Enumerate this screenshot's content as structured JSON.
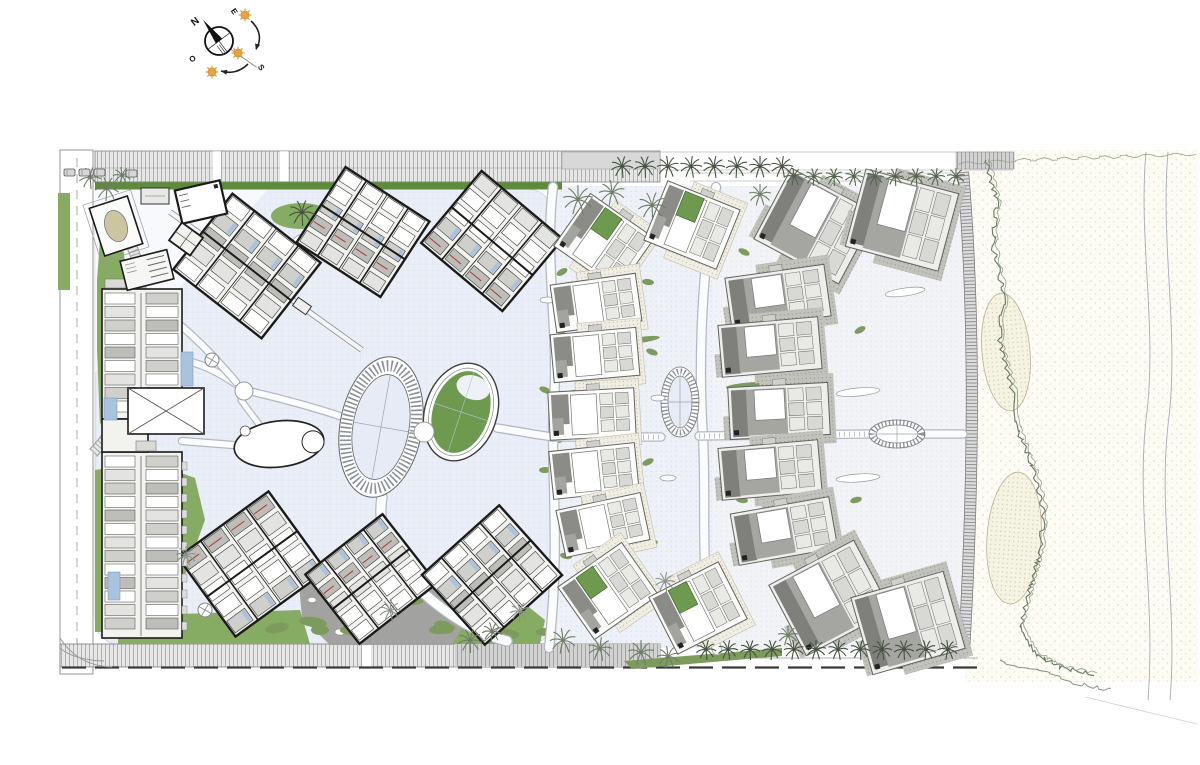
{
  "canvas": {
    "w": 1200,
    "h": 765,
    "bg": "#ffffff"
  },
  "palette": {
    "ink": "#1b1b1b",
    "paper": "#ffffff",
    "plaza": "#eaeef7",
    "plazaLine": "#dde3f0",
    "zone2": "#eef1f8",
    "zone3": "#f1f3f6",
    "dot": "#ccd4e6",
    "dot2": "#d6dae3",
    "sand": "#fcfbf4",
    "sandDot": "#cdc6af",
    "dune": "#f5f3e2",
    "duneDot": "#b9b194",
    "roadLight": "#e6e6e6",
    "roadMid": "#d2d2d2",
    "hatch": "#b0b0b0",
    "hatch2": "#a2a2a2",
    "roadEdge": "#7d7d7d",
    "hedge": "#5d8a3b",
    "lawn": "#86ab62",
    "olive": "#7d9b5d",
    "hedgeDark": "#3f6b2e",
    "palmDark": "#44523f",
    "palmMid": "#56644e",
    "palmSoft": "#6e7d66",
    "palmGray": "#8a958a",
    "blockFill": "#f2f2ef",
    "roomA": "#e3e3e1",
    "roomB": "#cfcfcc",
    "roomC": "#bdbdba",
    "roofD": "#7f7f7c",
    "roofM": "#a5a5a2",
    "roofS": "#8b8b88",
    "villaLine": "#62625f",
    "green2": "#6d9a4e",
    "blue": "#a9c3de",
    "red": "#b23a2c",
    "sun": "#e8a33d",
    "sunRay": "#d1912e",
    "pathCase": "#b3b8c2",
    "pathFill": "#fbfcfe",
    "corridorCase": "#8a8a8a",
    "grayShape": "#a2a2a0",
    "stipBg": "#f0eee3",
    "stipDot": "#a9a48c",
    "stipDBg": "#c2c2bc",
    "stipDDot": "#86867e",
    "shore": "#a8adb5",
    "veg": "#6a7862",
    "vegSoft": "#93a089",
    "boardTick": "#8f8f8f",
    "water": "#e6ebf5"
  },
  "compass": {
    "cx": 219,
    "cy": 41,
    "r": 14,
    "needle_deg": -127,
    "axis_deg": 53,
    "sunline_deg": 35,
    "letters": [
      {
        "t": "N",
        "x": 197,
        "y": 24,
        "rot": -38,
        "size": 10
      },
      {
        "t": "E",
        "x": 232,
        "y": 13,
        "rot": 55,
        "size": 8
      },
      {
        "t": "S",
        "x": 259,
        "y": 69,
        "rot": 55,
        "size": 8
      },
      {
        "t": "O",
        "x": 194,
        "y": 61,
        "rot": -35,
        "size": 8
      }
    ],
    "suns": [
      {
        "x": 245,
        "y": 15,
        "r": 4
      },
      {
        "x": 238,
        "y": 53,
        "r": 4
      },
      {
        "x": 212,
        "y": 72,
        "r": 4
      }
    ],
    "arrows": [
      {
        "d": "M251,21 C260,29 262,40 256,49",
        "tip": [
          256,
          50
        ],
        "ang": 105
      },
      {
        "d": "M248,64 C240,72 230,74 221,71",
        "tip": [
          221,
          71
        ],
        "ang": 192
      }
    ]
  },
  "roads": {
    "top": {
      "x": 95,
      "y": 151,
      "w": 565,
      "h": 31,
      "gaps": [
        213,
        280
      ],
      "hedge": [
        95,
        181.5,
        467,
        8
      ]
    },
    "promenade": [
      562,
      152,
      98,
      17
    ],
    "beach_link": [
      956,
      152,
      58,
      17
    ],
    "top_lines": [
      [
        60,
        151,
        660,
        151
      ],
      [
        60,
        182,
        660,
        182
      ],
      [
        660,
        152,
        1013,
        152
      ],
      [
        660,
        170,
        1013,
        170
      ],
      [
        690,
        173,
        958,
        173
      ],
      [
        690,
        181,
        958,
        181
      ]
    ],
    "left": {
      "x": 60,
      "y": 150,
      "w": 33,
      "h": 524,
      "dash_x": 77
    },
    "bottom": {
      "x": 60,
      "y": 644,
      "w": 600,
      "h": 23,
      "gap": 362,
      "dark_from": 455
    },
    "bottom_dash": [
      62,
      667.5,
      978,
      667.5
    ],
    "bottom_thin": [
      660,
      658,
      978,
      658
    ],
    "corner_curves": [
      "M60,638 Q78,666 112,667",
      "M60,648 Q74,660 104,661"
    ]
  },
  "zones": {
    "plaza": [
      95,
      189,
      458,
      456
    ],
    "entrance_blob": "M95,189 L268,189 C236,226 206,254 176,292 C150,325 122,356 95,372 Z",
    "zone2": [
      553,
      186,
      160,
      462
    ],
    "zone3": [
      713,
      186,
      252,
      464
    ]
  },
  "paths": {
    "walks": [
      {
        "d": "M553,187 C544,262 559,330 554,400 C550,470 561,540 549,648",
        "w": 8
      },
      {
        "d": "M716,187 C702,268 698,360 703,437 C707,515 698,585 717,650",
        "w": 8
      },
      {
        "d": "M497,428 C523,432 537,435 553,437 L661,437",
        "w": 7
      },
      {
        "d": "M699,436 L869,434",
        "w": 7
      },
      {
        "d": "M925,434 L963,434",
        "w": 7
      },
      {
        "d": "M253,392 C292,401 322,410 346,418",
        "w": 6
      },
      {
        "d": "M236,384 C214,369 196,362 179,359",
        "w": 6
      },
      {
        "d": "M241,400 C251,414 259,424 265,432",
        "w": 5
      },
      {
        "d": "M382,497 C375,541 401,580 450,614 C472,629 491,637 507,641",
        "w": 9
      },
      {
        "d": "M182,441 C206,443 221,444 233,445",
        "w": 6
      },
      {
        "d": "M150,302 C192,331 216,359 236,382",
        "w": 6
      }
    ],
    "corridors": [
      {
        "d": "M170,212 L362,350",
        "w": 6
      }
    ],
    "drive": "M93,213 C132,226 143,262 141,306 C139,352 132,396 112,429 C105,440 98,448 93,453",
    "axis_ticks": [
      "M553,437 L661,437",
      "M699,436 L869,434"
    ]
  },
  "lagoon": {
    "pond": {
      "cx": 279,
      "cy": 444,
      "rx": 45,
      "ry": 23,
      "rot": -7,
      "inner": {
        "dx": 34,
        "dy": 2,
        "r": 11
      },
      "nub": {
        "dx": -32,
        "dy": -17,
        "r": 5
      }
    },
    "ring": {
      "cx": 381,
      "cy": 427,
      "rot": 10,
      "rxO": 41,
      "ryO": 71,
      "rxI": 28,
      "ryI": 53
    },
    "green_oval": {
      "cx": 461,
      "cy": 412,
      "rot": 18,
      "rxO": 36,
      "ryO": 50,
      "rxR": 31,
      "ryR": 45,
      "rxI": 28,
      "ryI": 42,
      "crescent": {
        "dx": 4,
        "dy": -27,
        "rx": 17,
        "ry": 12
      }
    },
    "node": {
      "cx": 244,
      "cy": 391,
      "r": 9
    },
    "blob": {
      "cx": 424,
      "cy": 432,
      "r": 10
    },
    "oval_node_v": {
      "cx": 680,
      "cy": 402,
      "rxO": 19,
      "ryO": 35,
      "rxI": 12,
      "ryI": 26
    },
    "oval_node_h": {
      "cx": 897,
      "cy": 434,
      "rxO": 28,
      "ryO": 14,
      "rxI": 21,
      "ryI": 9
    }
  },
  "buildings": {
    "hotel_blocks": [
      [
        247,
        266,
        112,
        96,
        38
      ],
      [
        363,
        232,
        100,
        90,
        33
      ],
      [
        492,
        241,
        106,
        94,
        40
      ],
      [
        252,
        564,
        112,
        98,
        -36
      ],
      [
        371,
        579,
        98,
        88,
        -38
      ],
      [
        492,
        575,
        104,
        94,
        -42
      ]
    ],
    "left_wing": {
      "base1": [
        102,
        289,
        80,
        130
      ],
      "base2": [
        102,
        452,
        80,
        186
      ],
      "mid": [
        102,
        419,
        46,
        33
      ],
      "xhall": [
        128,
        388,
        76,
        46
      ],
      "pools": [
        [
          181,
          352,
          12,
          34
        ],
        [
          104,
          398,
          13,
          22
        ],
        [
          108,
          572,
          12,
          28
        ]
      ],
      "canopies": [
        [
          105,
          279,
          30,
          9
        ],
        [
          136,
          441,
          20,
          10
        ]
      ]
    },
    "entrance": [
      {
        "type": "white_rect",
        "cx": 201,
        "cy": 202,
        "w": 46,
        "h": 34,
        "rot": -13
      },
      {
        "type": "oval_pavilion",
        "cx": 116,
        "cy": 226,
        "w": 40,
        "h": 50,
        "rot": -18,
        "oval": {
          "rx": 11,
          "ry": 16,
          "fill": "#cbc5a2"
        }
      },
      {
        "type": "striped",
        "cx": 147,
        "cy": 270,
        "w": 48,
        "h": 30,
        "rot": -14
      },
      {
        "type": "dark_square",
        "cx": 186,
        "cy": 239,
        "w": 26,
        "h": 22,
        "rot": 36
      },
      {
        "type": "svc",
        "cx": 155,
        "cy": 196,
        "w": 28,
        "h": 16,
        "rot": 0
      }
    ],
    "stair_rect": [
      302,
      306,
      16,
      10,
      35
    ]
  },
  "villas": {
    "small": {
      "w": 86,
      "h": 48,
      "aw": 78,
      "ah": 64,
      "list": [
        [
          604,
          242,
          35,
          "a"
        ],
        [
          692,
          225,
          22,
          "a"
        ],
        [
          596,
          303,
          -8,
          "c"
        ],
        [
          595,
          355,
          -5,
          "c"
        ],
        [
          592,
          414,
          -3,
          "c"
        ],
        [
          594,
          471,
          -6,
          "c"
        ],
        [
          603,
          525,
          -12,
          "c"
        ],
        [
          608,
          591,
          -35,
          "a"
        ],
        [
          698,
          608,
          -27,
          "a"
        ]
      ]
    },
    "large": {
      "w": 100,
      "h": 52,
      "aw": 96,
      "ah": 80,
      "list": [
        [
          815,
          226,
          28,
          "a"
        ],
        [
          902,
          220,
          15,
          "a"
        ],
        [
          778,
          297,
          -8,
          "c"
        ],
        [
          770,
          347,
          -5,
          "c"
        ],
        [
          779,
          411,
          -3,
          "c"
        ],
        [
          770,
          470,
          -5,
          "c"
        ],
        [
          784,
          531,
          -10,
          "c"
        ],
        [
          830,
          598,
          -28,
          "a"
        ],
        [
          908,
          623,
          -16,
          "a"
        ]
      ]
    }
  },
  "greens": {
    "lawns": [
      "95,470 150,462 195,478 205,520 185,575 150,612 112,632 95,632",
      "118,616 300,610 310,644 118,644",
      "428,598 470,588 520,600 545,620 540,644 452,644 430,622",
      "58,193 70,193 70,290 58,290",
      "100,240 124,252 128,300 124,355 112,400 100,425 97,350 97,280"
    ],
    "gray_blob": "298,572 352,556 408,570 452,590 468,618 452,645 330,645 302,618",
    "blob_trees": [
      [
        330,
        588,
        14,
        8,
        -20
      ],
      [
        368,
        614,
        16,
        9,
        12
      ],
      [
        414,
        598,
        12,
        7,
        -5
      ],
      [
        444,
        627,
        10,
        6,
        20
      ],
      [
        320,
        630,
        9,
        5,
        0
      ]
    ],
    "pebbles": [
      [
        312,
        600,
        4,
        2.5
      ],
      [
        340,
        632,
        5,
        3
      ]
    ],
    "hedge_small": [
      107,
      552,
      26,
      12,
      -5
    ],
    "palm_oval": [
      301,
      216,
      30,
      13
    ],
    "olive_row": [
      [
        277,
        628,
        12,
        5,
        -10
      ],
      [
        313,
        622,
        14,
        5,
        8
      ],
      [
        352,
        630,
        12,
        5,
        0
      ],
      [
        442,
        629,
        13,
        5,
        -6
      ],
      [
        507,
        634,
        12,
        5,
        5
      ],
      [
        546,
        632,
        10,
        4,
        0
      ]
    ],
    "hedge_triangle": "624,661 782,648 782,656 632,669",
    "hedge_rows": [
      [
        600,
        391,
        38,
        4,
        -4
      ],
      [
        600,
        508,
        28,
        3.5,
        -6
      ],
      [
        756,
        386,
        30,
        4,
        -3
      ],
      [
        640,
        340,
        20,
        3,
        -8
      ]
    ],
    "bushes": [
      [
        562,
        272
      ],
      [
        648,
        282
      ],
      [
        560,
        332
      ],
      [
        652,
        352
      ],
      [
        558,
        440
      ],
      [
        648,
        462
      ],
      [
        566,
        556
      ],
      [
        652,
        543
      ],
      [
        744,
        252
      ],
      [
        856,
        252
      ],
      [
        742,
        560
      ],
      [
        864,
        560
      ],
      [
        740,
        318
      ],
      [
        860,
        330
      ],
      [
        742,
        500
      ],
      [
        856,
        500
      ],
      [
        545,
        390
      ],
      [
        545,
        470
      ]
    ],
    "white_ovals": [
      [
        303,
        238,
        10,
        4,
        -15
      ],
      [
        530,
        252,
        9,
        4,
        12
      ],
      [
        905,
        292,
        20,
        4,
        -8
      ],
      [
        858,
        392,
        22,
        4,
        -5
      ],
      [
        858,
        478,
        22,
        4,
        -4
      ],
      [
        902,
        588,
        18,
        4,
        6
      ],
      [
        548,
        300,
        8,
        3,
        0
      ],
      [
        658,
        398,
        7,
        3,
        0
      ],
      [
        920,
        225,
        10,
        3,
        20
      ],
      [
        668,
        478,
        8,
        3,
        0
      ]
    ],
    "fountains": [
      [
        212,
        360,
        7
      ],
      [
        205,
        610,
        7
      ]
    ]
  },
  "palms": {
    "rows": [
      {
        "y": 167,
        "r": 11,
        "c": "palmDark",
        "xs": [
          622,
          645,
          668,
          691,
          714,
          737,
          760,
          782
        ]
      },
      {
        "y": 177,
        "r": 9,
        "c": "palmMid",
        "xs": [
          794,
          814,
          834,
          854,
          875,
          895,
          916,
          936,
          956
        ]
      },
      {
        "y": 650,
        "r": 10,
        "c": "palmDark",
        "xs": [
          706,
          728,
          750,
          772,
          794,
          816,
          838,
          860,
          882,
          904,
          926,
          948
        ]
      }
    ],
    "single": [
      [
        578,
        200,
        15,
        "palmSoft"
      ],
      [
        612,
        193,
        13,
        "palmSoft"
      ],
      [
        652,
        206,
        14,
        "palmSoft"
      ],
      [
        90,
        178,
        11,
        "palmSoft"
      ],
      [
        107,
        189,
        12,
        "palmSoft"
      ],
      [
        122,
        176,
        9,
        "palmSoft"
      ],
      [
        470,
        641,
        12,
        "palmSoft"
      ],
      [
        492,
        632,
        10,
        "palmSoft"
      ],
      [
        563,
        641,
        13,
        "palmSoft"
      ],
      [
        600,
        649,
        12,
        "palmSoft"
      ],
      [
        641,
        653,
        13,
        "palmSoft"
      ],
      [
        668,
        657,
        11,
        "palmSoft"
      ],
      [
        186,
        556,
        10,
        "palmGray"
      ],
      [
        390,
        611,
        11,
        "palmGray"
      ],
      [
        520,
        612,
        10,
        "palmGray"
      ],
      [
        665,
        582,
        10,
        "palmGray"
      ],
      [
        760,
        195,
        11,
        "palmSoft"
      ],
      [
        788,
        636,
        10,
        "palmSoft"
      ],
      [
        302,
        213,
        13,
        "palmDark"
      ]
    ]
  },
  "beach": {
    "sand": [
      965,
      150,
      233,
      532
    ],
    "boardwalk": "M963,172 C974,300 975,460 964,652",
    "dunes": [
      [
        1006,
        352,
        24,
        59,
        -5
      ],
      [
        1014,
        538,
        27,
        66,
        4
      ]
    ],
    "shore": [
      "M1146,152 C1138,240 1158,330 1146,420 C1136,510 1156,600 1148,700",
      "M1168,152 C1160,245 1180,335 1168,425 C1158,515 1178,605 1170,700"
    ],
    "veg_main": [
      [
        986,
        160
      ],
      [
        997,
        200
      ],
      [
        993,
        245
      ],
      [
        1004,
        295
      ],
      [
        999,
        340
      ],
      [
        1013,
        392
      ],
      [
        1019,
        432
      ],
      [
        1034,
        472
      ],
      [
        1044,
        512
      ],
      [
        1040,
        552
      ],
      [
        1029,
        592
      ],
      [
        1021,
        625
      ],
      [
        1037,
        655
      ],
      [
        1063,
        668
      ],
      [
        1093,
        674
      ]
    ],
    "veg_top": [
      [
        958,
        164
      ],
      [
        1020,
        160
      ],
      [
        1080,
        158
      ],
      [
        1140,
        156
      ],
      [
        1195,
        154
      ]
    ],
    "veg_bottom": [
      [
        1000,
        660
      ],
      [
        1040,
        672
      ],
      [
        1080,
        684
      ],
      [
        1110,
        690
      ]
    ],
    "corner_line": "M1085,697 L1197,724"
  },
  "cars": [
    [
      64,
      169
    ],
    [
      79,
      169
    ],
    [
      94,
      169
    ],
    [
      126,
      170
    ]
  ]
}
